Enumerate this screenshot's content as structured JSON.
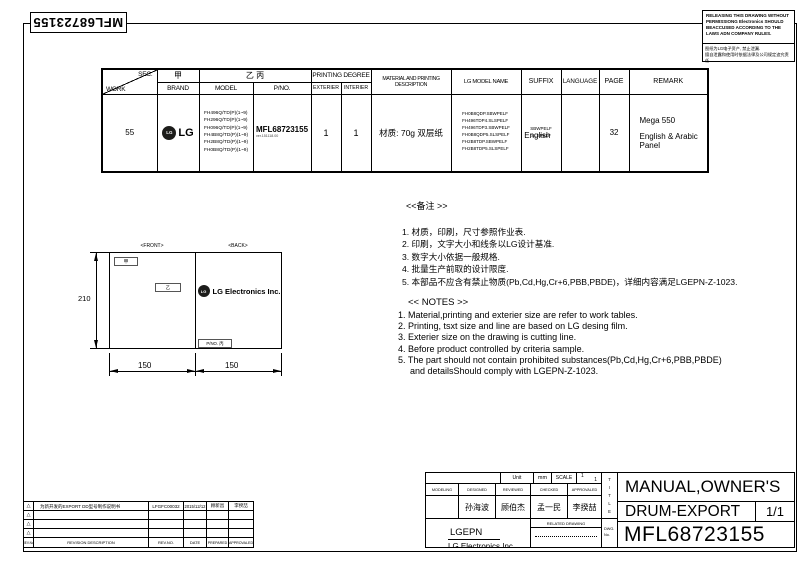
{
  "side_label": {
    "pno": "MFL68723155"
  },
  "warning_box": {
    "en": "RELEASING THIS DRAWING WITHOUT PERMISSIONG Electronics SHOULD BEACCUSED ACCORDING TO THE LAWS ADN COMPANY RULES.",
    "cn_line1": "图纸为LG电子资产, 禁止泄漏.",
    "cn_line2": "擅自泄露和使用时依据法律及公司规定追究责任"
  },
  "spec_table": {
    "header": {
      "sec": "SEC.",
      "work": "WORK",
      "jia": "甲",
      "brand": "BRAND",
      "yi_bing": "乙 丙",
      "model": "MODEL",
      "pno": "P/NO.",
      "printing_degree": "PRINTING DEGREE",
      "exterier": "EXTERIER",
      "interier": "INTERIER",
      "material": "MATERIAL AND PRINTING DESCRIPTION",
      "lg_model_name": "LG MODEL NAME",
      "suffix": "SUFFIX",
      "language": "LANGUAGE",
      "page": "PAGE",
      "remark": "REMARK"
    },
    "row": {
      "work": "55",
      "brand": {
        "symbol": "LG",
        "wordmark": "LG"
      },
      "models": [
        "FH496Q/TD(P)(1~9)",
        "FH296Q/TD(P)(1~9)",
        "FH096Q/TD(P)(1~9)",
        "FH4B8Q/TD(P)(1~9)",
        "FH2B8Q/TD(P)(1~9)",
        "FH0B8Q/TD(P)(1~9)"
      ],
      "pno": "MFL68723155",
      "pno_version": "ver.151118.00",
      "exterier": "1",
      "interier": "1",
      "material": "材质: 70g 双层纸",
      "lg_models": [
        "FH0B8QDP.SBWPELF",
        "FH496TDP4.SLSPELF",
        "FH496TDP3.SBWPELF",
        "FH0B8QDP5.SLSPELF",
        "FH2B8TDP.SBWPELF",
        "FH2B8TDP5.SLSPELF"
      ],
      "suffix_line1": "SBWPELF",
      "suffix_line2": "SLSPELF",
      "suffix_overlay": "English",
      "page": "32",
      "remark_line1": "Mega 550",
      "remark_line2": "English & Arabic",
      "remark_line3": "Panel"
    }
  },
  "drawing": {
    "front_label": "<FRONT>",
    "back_label": "<BACK>",
    "jia_box": "甲",
    "yi_box": "乙",
    "pno_box": "P/NO. 丙",
    "logo_symbol": "LG",
    "logo_text": "LG Electronics Inc.",
    "dim_height": "210",
    "dim_width_left": "150",
    "dim_width_right": "150"
  },
  "notes_cn": {
    "title": "<<备注 >>",
    "items": [
      "1. 材质，印刷，尺寸参照作业表.",
      "2. 印刷，文字大小和线条以LG设计基准.",
      "3. 数字大小依据一般规格.",
      "4. 批量生产前取的设计限度.",
      "5. 本部品不应含有禁止物质(Pb,Cd,Hg,Cr+6,PBB,PBDE)，详细内容满足LGEPN-Z-1023."
    ]
  },
  "notes_en": {
    "title": "<< NOTES >>",
    "items": [
      "1. Material,printing and exterier size are refer to work tables.",
      "2. Printing, tsxt  size and line are based on LG desing film.",
      "3. Exterier size on the drawing is cutting line.",
      "4. Before product controlled by criteria sample.",
      "5. The part should not contain prohibited substances(Pb,Cd,Hg,Cr+6,PBB,PBDE)",
      "and detailsShould comply with LGEPN-Z-1023."
    ]
  },
  "revision_table": {
    "rows": [
      {
        "marker": "△",
        "description": "为新开发的EXPORT DD型号制作说明书",
        "rev_no": "LFGFC00032",
        "date": "2015/12/12",
        "prepared": "顾新昌",
        "approved": "李揆喆"
      },
      {
        "marker": "△",
        "description": "",
        "rev_no": "",
        "date": "",
        "prepared": "",
        "approved": ""
      },
      {
        "marker": "△",
        "description": "",
        "rev_no": "",
        "date": "",
        "prepared": "",
        "approved": ""
      },
      {
        "marker": "△",
        "description": "",
        "rev_no": "",
        "date": "",
        "prepared": "",
        "approved": ""
      }
    ],
    "footer": {
      "rev_label": "REV.No.",
      "description": "REVISION DESCRIPTION",
      "rev_no": "REV.NO.",
      "date": "DATE",
      "prepared": "PREPARED",
      "approved": "APPROVALED"
    }
  },
  "title_block": {
    "unit_label": "Unit",
    "unit_value": "mm",
    "scale_label": "SCALE",
    "scale_top": "1",
    "scale_bottom": "1",
    "col_modeling": "MODELING",
    "col_designed": "DESIGNED",
    "col_reviewed": "REVIEWED",
    "col_checked": "CHECKED",
    "col_approvaled": "APPROVALED",
    "name_designed": "孙海波",
    "name_reviewed": "顾伯杰",
    "name_checked": "孟一民",
    "name_approvaled": "李揆喆",
    "company_short": "LGEPN",
    "company_full": "LG Electronics Inc.",
    "related_drawing": "RELATED DRAWING",
    "dwg_label_1": "DWG.",
    "dwg_label_2": "No.",
    "title_vertical": [
      "T",
      "I",
      "T",
      "L",
      "E"
    ],
    "title_line1": "MANUAL,OWNER'S",
    "title_line2": "DRUM-EXPORT",
    "sheet": "1/1",
    "dwg_no": "MFL68723155"
  }
}
